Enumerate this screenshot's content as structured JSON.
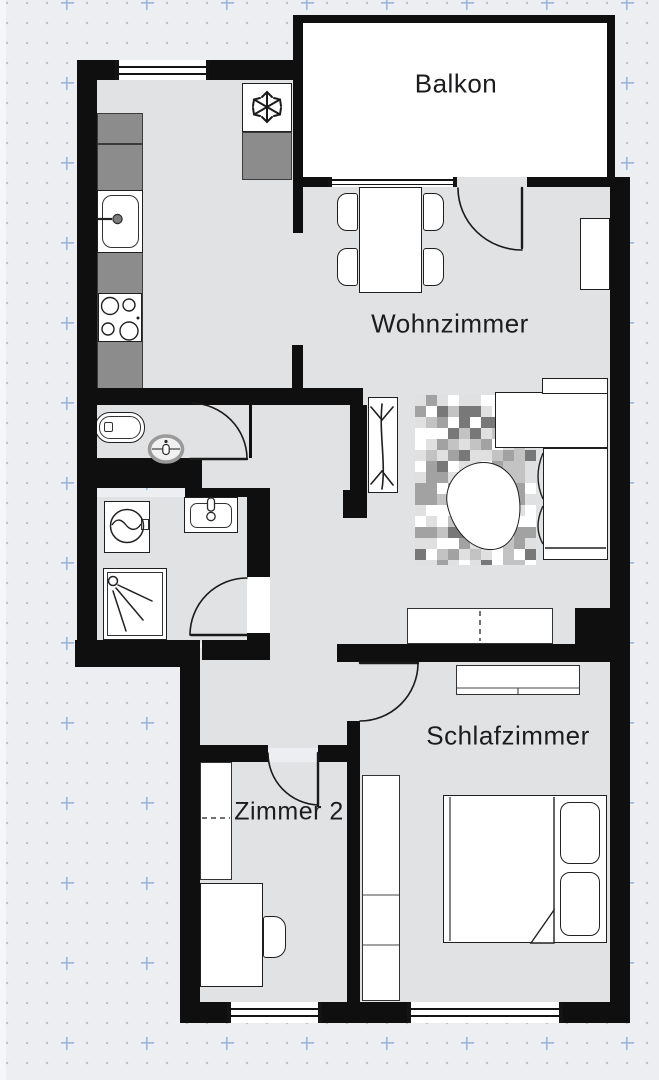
{
  "floorplan": {
    "type": "apartment-floor-plan",
    "labels": {
      "balkon": "Balkon",
      "wohnzimmer": "Wohnzimmer",
      "schlafzimmer": "Schlafzimmer",
      "zimmer2": "Zimmer 2"
    },
    "unlabeled_areas": [
      "kitchen",
      "wc",
      "bathroom",
      "hallway"
    ],
    "colors": {
      "background": "#edeef1",
      "grid_dot": "#bfc3cc",
      "grid_plus": "#9db9da",
      "wall": "#0f0f10",
      "floor": "#e1e2e3",
      "balcony_floor": "#ffffff",
      "kitchen_counter": "#8c8c8c",
      "furniture_fill": "#ffffff",
      "line": "#1f1f1f"
    },
    "furniture": [
      "kitchen-counter",
      "kitchen-sink",
      "stove",
      "fridge-freezer",
      "toilet",
      "bidet",
      "washing-machine",
      "bathroom-sink",
      "shower",
      "dining-table",
      "dining-chair",
      "sideboard",
      "plant-shelf",
      "sofa",
      "coffee-table",
      "rug",
      "sliding-wardrobe",
      "dresser",
      "bedroom-wardrobe",
      "double-bed",
      "pillow",
      "zimmer2-wardrobe",
      "desk",
      "desk-chair"
    ]
  }
}
